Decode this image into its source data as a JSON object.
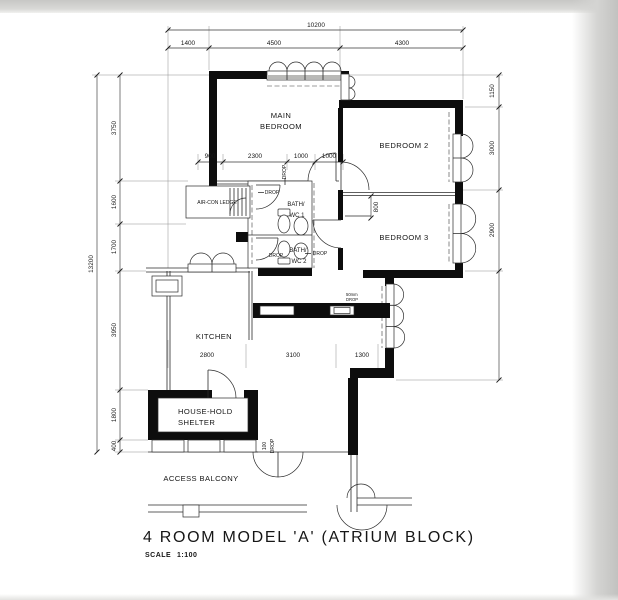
{
  "page": {
    "title": "4 ROOM MODEL 'A' (ATRIUM BLOCK)",
    "scale_label": "SCALE",
    "scale_value": "1:100"
  },
  "rooms": {
    "main_bedroom_1": "MAIN",
    "main_bedroom_2": "BEDROOM",
    "bedroom_2": "BEDROOM 2",
    "bedroom_3": "BEDROOM 3",
    "kitchen": "KITCHEN",
    "household_shelter_1": "HOUSE-HOLD",
    "household_shelter_2": "SHELTER",
    "access_balcony": "ACCESS BALCONY",
    "aircon_ledge": "AIR-CON LEDGE",
    "bath_wc_1_a": "BATH/",
    "bath_wc_1_b": "WC 1",
    "bath_wc_2_a": "BATH/",
    "bath_wc_2_b": "WC 2"
  },
  "dims": {
    "overall_width": "10200",
    "overall_height": "13200",
    "top": [
      "1400",
      "4500",
      "4300"
    ],
    "left": [
      "3750",
      "1600",
      "1700",
      "3950",
      "1800",
      "400"
    ],
    "right": [
      "1150",
      "3000",
      "2900"
    ],
    "upper": [
      "900",
      "2300",
      "1000",
      "1000"
    ],
    "lower": [
      "2800",
      "3100",
      "1300"
    ],
    "recess": "800",
    "entrance_step_1": "100",
    "entrance_step_2": "DROP",
    "drop": "DROP",
    "counter_note_1": "50mm",
    "counter_note_2": "DROP"
  }
}
